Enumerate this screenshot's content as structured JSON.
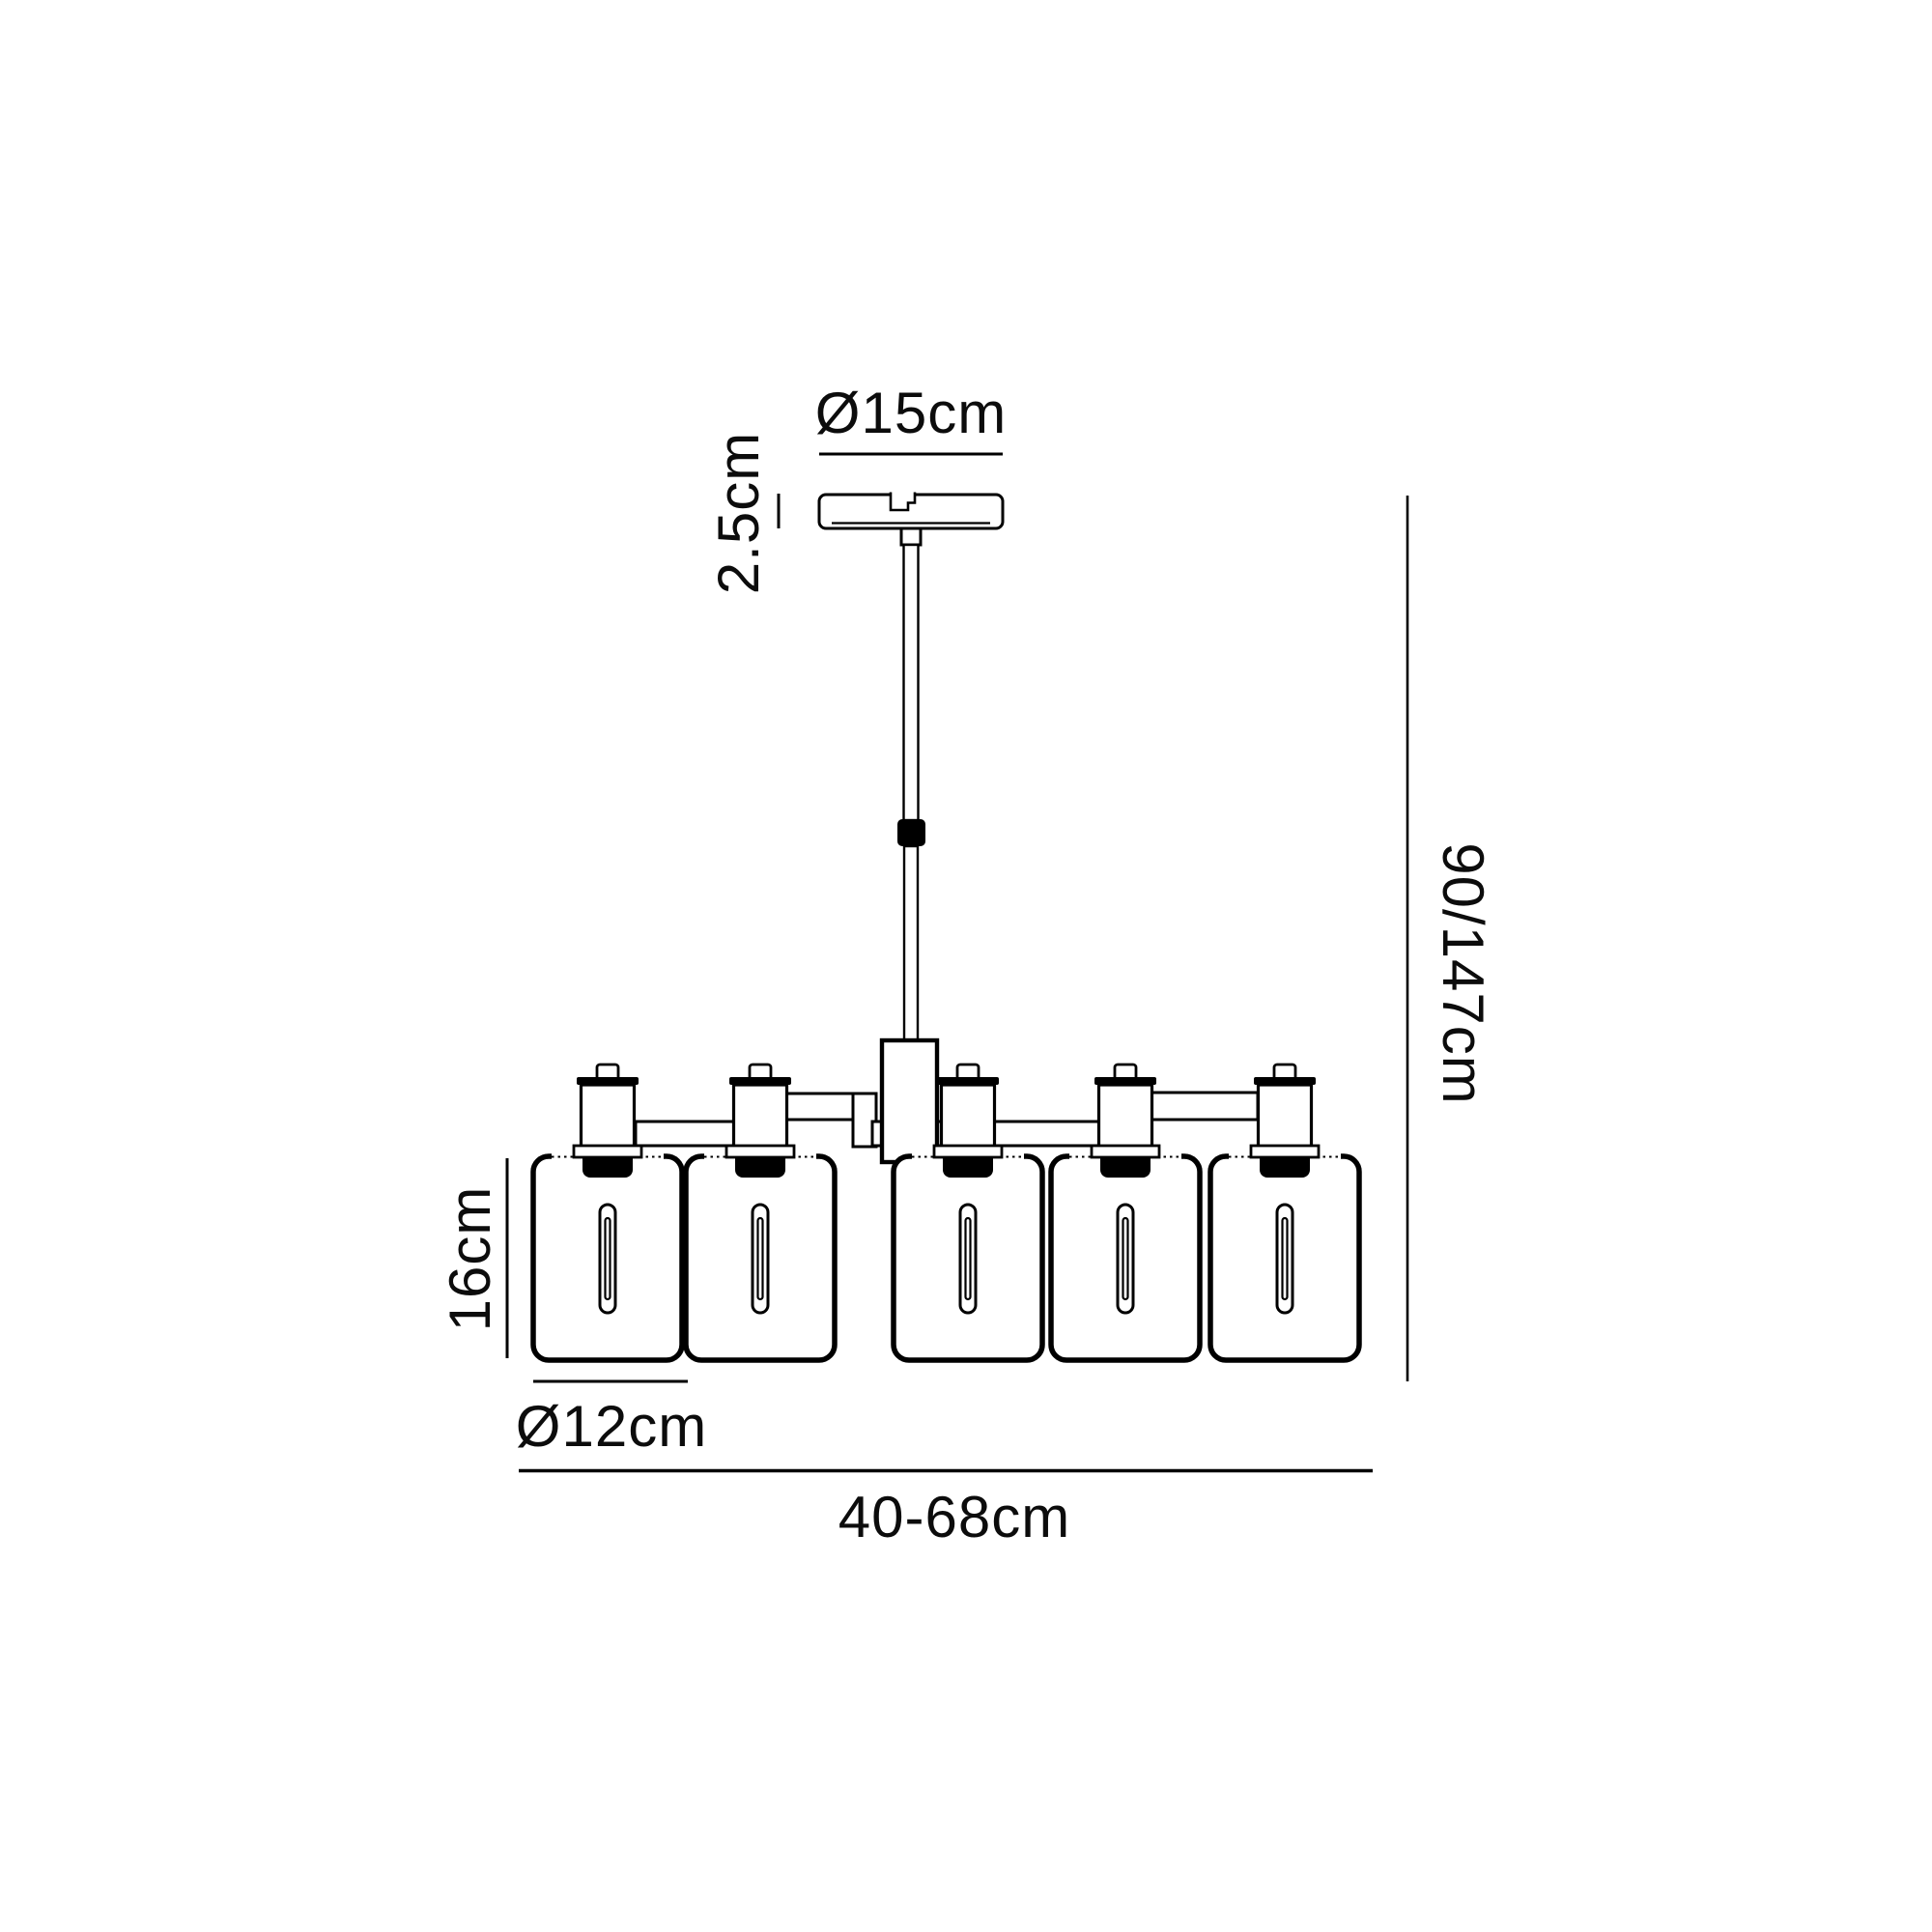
{
  "page": {
    "background": "#ffffff",
    "line_color": "#000000",
    "text_color": "#0c0c0c"
  },
  "diagram": {
    "type": "product-dimension-drawing",
    "subject": "5-shade telescopic chandelier",
    "shade_count": 5,
    "labels": {
      "canopy_diameter": "Ø15cm",
      "canopy_height": "2.5cm",
      "drop_height": "90/147cm",
      "shade_height": "16cm",
      "shade_diameter": "Ø12cm",
      "fixture_width": "40-68cm"
    }
  }
}
